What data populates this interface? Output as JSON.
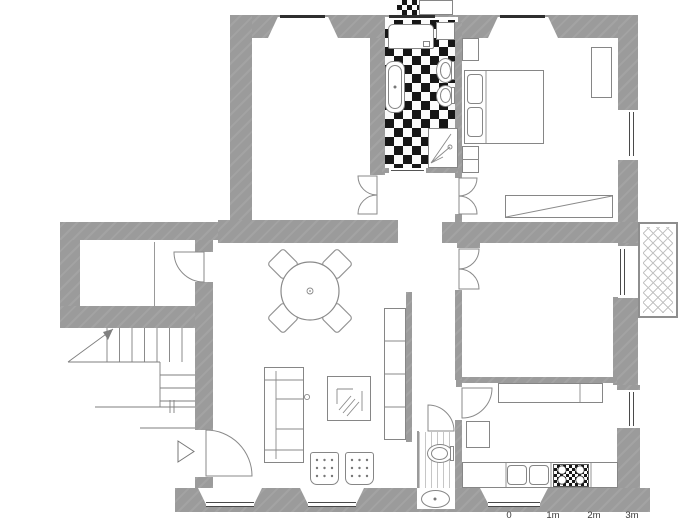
{
  "scale_bar": {
    "labels": [
      "0",
      "1m",
      "2m",
      "3m"
    ]
  },
  "colors": {
    "wall": "#9b9b9b",
    "furniture_line": "#868686",
    "tile_dark": "#161616",
    "lintel": "#2e2e2e",
    "background": "#ffffff"
  }
}
